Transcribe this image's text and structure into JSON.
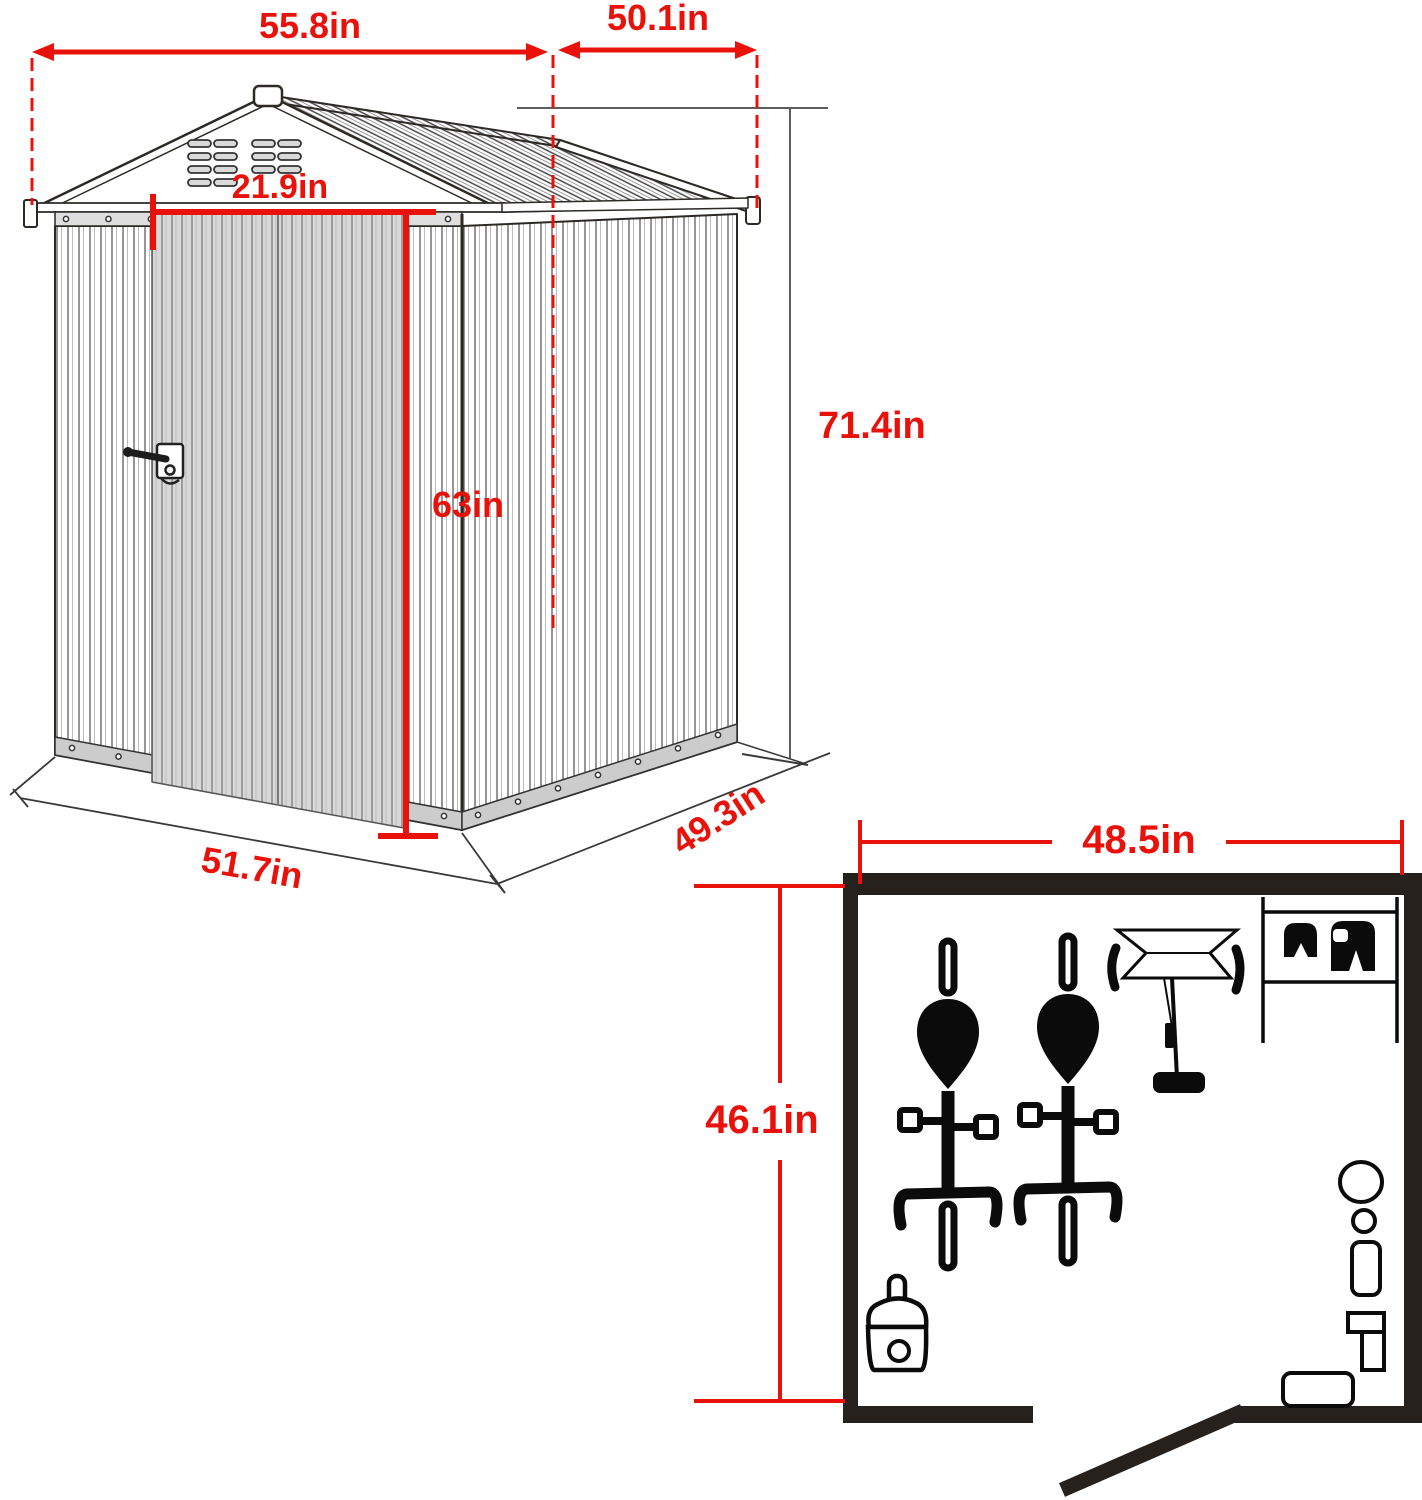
{
  "title": "Storage shed dimension diagram",
  "colors": {
    "dimension_red": "#e8120b",
    "line_dark": "#2d2a26",
    "floor_plan_wall": "#27211e",
    "door_gray": "#d8d8d8"
  },
  "shed": {
    "labels": {
      "roof_width": "55.8in",
      "roof_depth": "50.1in",
      "door_width": "21.9in",
      "door_height": "63in",
      "total_height": "71.4in",
      "base_width": "51.7in",
      "base_depth": "49.3in"
    }
  },
  "floor_plan": {
    "labels": {
      "interior_width": "48.5in",
      "interior_depth": "46.1in"
    },
    "icons": [
      "bicycle-icon",
      "bicycle-icon",
      "lawn-mower-icon",
      "wall-shelf-icon",
      "helmet-icon",
      "boot-icon",
      "paint-bucket-icon",
      "round-table-icon",
      "stool-icon",
      "storage-box-icon",
      "mallet-icon",
      "bench-icon",
      "open-door-leaf-icon"
    ]
  }
}
